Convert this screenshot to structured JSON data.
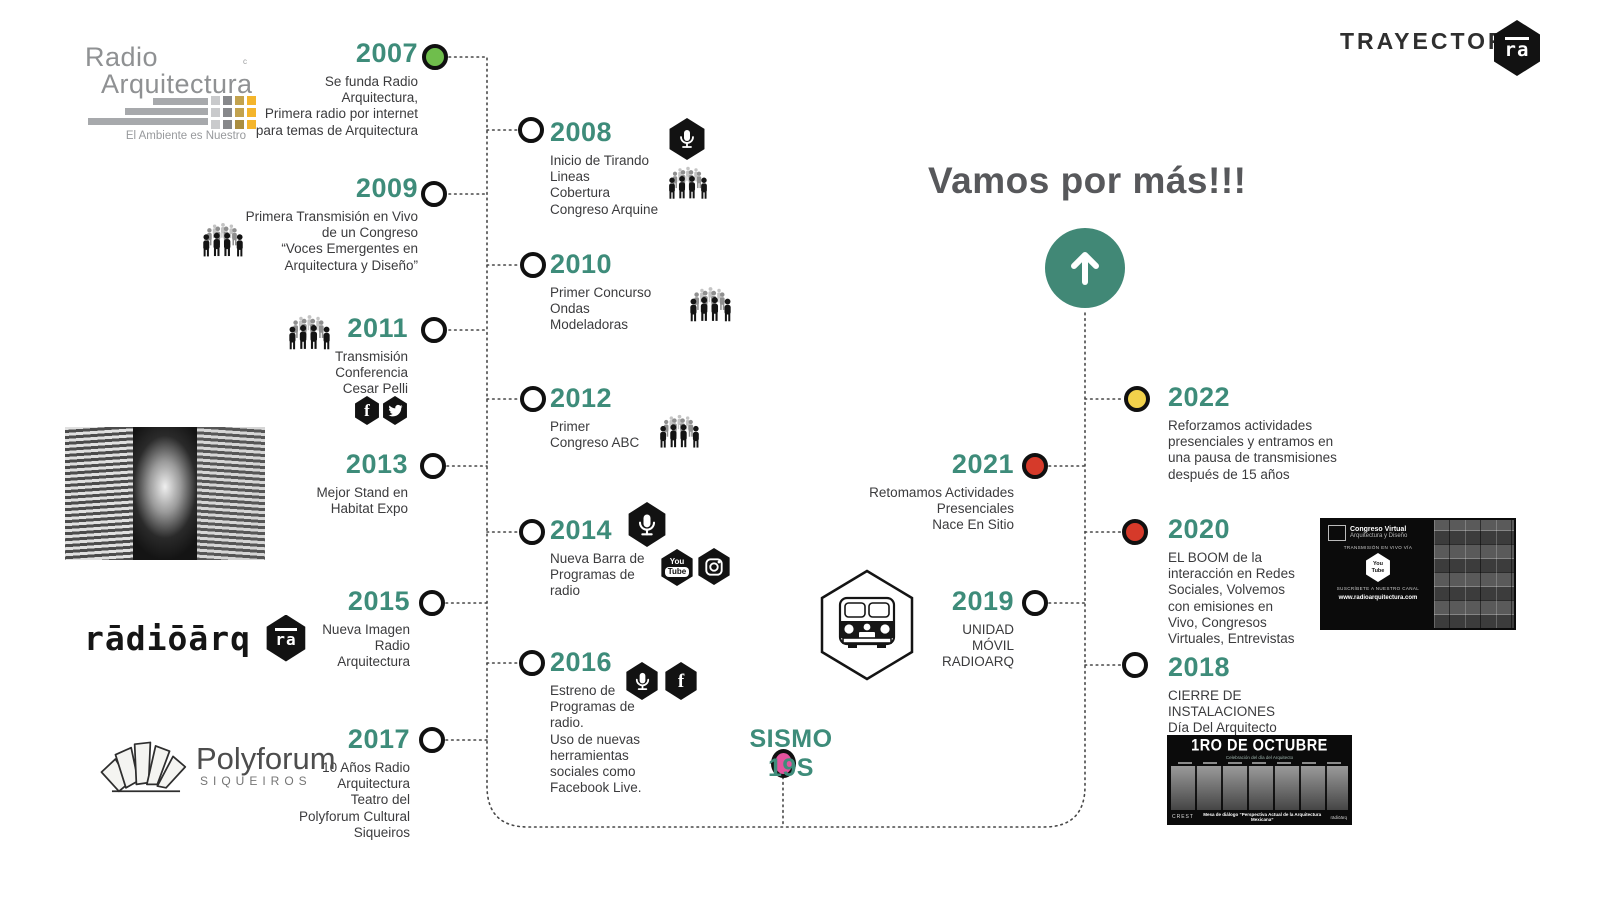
{
  "header": {
    "trayectoria_label": "TRAYECTORIA",
    "ra_monogram": "ra"
  },
  "brand_logo": {
    "line1": "Radio",
    "line2": "Arquitectura",
    "registered_mark": "c",
    "tagline": "El Ambiente es Nuestro"
  },
  "heading": "Vamos por más!!!",
  "sismo_label": "SISMO 19S",
  "radioarq_logo": {
    "wordmark": "rādiōārq",
    "monogram": "ra"
  },
  "polyforum_logo": {
    "name": "Polyforum",
    "sub": "SIQUEIROS"
  },
  "congreso_card": {
    "title": "Congreso Virtual",
    "subtitle": "Arquitectura y Diseño",
    "live_label": "TRANSMISIÓN EN VIVO VÍA",
    "youtube_top": "You",
    "youtube_bottom": "Tube",
    "subscribe_label": "SUSCRÍBETE A NUESTRO CANAL",
    "url": "www.radioarquitectura.com"
  },
  "octubre_poster": {
    "title": "1RO DE OCTUBRE",
    "subtitle": "Celebración del día del Arquitecto",
    "footer_left": "CREST",
    "footer_center": "Mesa de diálogo “Perspectiva Actual de la Arquitectura Mexicana”",
    "footer_right": "rādiōārq"
  },
  "milestones": [
    {
      "year": "2007",
      "text": "Se funda Radio\nArquitectura,\nPrimera radio por internet\npara temas de Arquitectura"
    },
    {
      "year": "2008",
      "text": "Inicio de Tirando\nLineas\nCobertura\nCongreso Arquine"
    },
    {
      "year": "2009",
      "text": "Primera Transmisión en Vivo\nde un Congreso\n“Voces Emergentes en\nArquitectura y Diseño”"
    },
    {
      "year": "2010",
      "text": "Primer Concurso\nOndas\nModeladoras"
    },
    {
      "year": "2011",
      "text": "Transmisión\nConferencia\nCesar Pelli"
    },
    {
      "year": "2012",
      "text": "Primer\nCongreso ABC"
    },
    {
      "year": "2013",
      "text": "Mejor Stand en\nHabitat Expo"
    },
    {
      "year": "2014",
      "text": "Nueva Barra de\nProgramas de\nradio"
    },
    {
      "year": "2015",
      "text": "Nueva Imagen\nRadio\nArquitectura"
    },
    {
      "year": "2016",
      "text": "Estreno de\nProgramas de\nradio.\nUso de nuevas\nherramientas\nsociales como\nFacebook Live."
    },
    {
      "year": "2017",
      "text": "10 Años Radio\nArquitectura\nTeatro del\nPolyforum Cultural\nSiqueiros"
    },
    {
      "year": "2018",
      "text": "CIERRE DE\nINSTALACIONES\nDía Del Arquitecto"
    },
    {
      "year": "2019",
      "text": "UNIDAD\nMÓVIL\nRADIOARQ"
    },
    {
      "year": "2020",
      "text": "EL BOOM de la\ninteracción en Redes\nSociales, Volvemos\ncon emisiones en\nVivo, Congresos\nVirtuales, Entrevistas"
    },
    {
      "year": "2021",
      "text": "Retomamos Actividades\nPresenciales\nNace En Sitio"
    },
    {
      "year": "2022",
      "text": "Reforzamos actividades\npresenciales y entramos en\nuna pausa de transmisiones\ndespués de 15 años"
    }
  ],
  "colors": {
    "accent_teal": "#3e8c7a",
    "dot_green": "#6fbe4c",
    "dot_red": "#d63a2a",
    "dot_yellow": "#f2d24b",
    "dot_pink": "#e4539e",
    "heading_gray": "#57585b"
  }
}
